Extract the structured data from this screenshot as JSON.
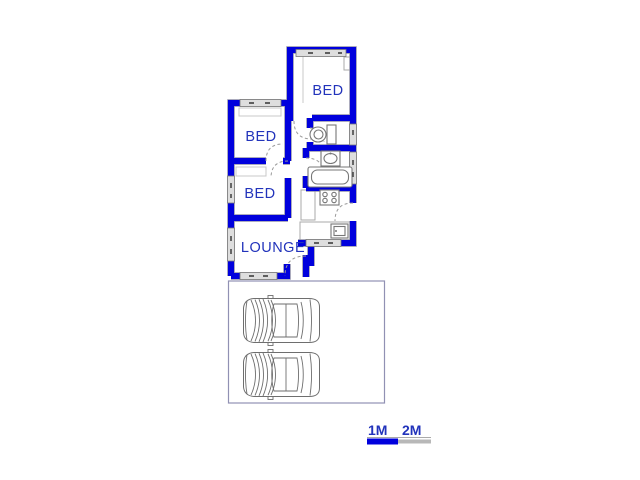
{
  "canvas": {
    "width": 640,
    "height": 480,
    "background": "#ffffff"
  },
  "floorplan": {
    "rooms": [
      {
        "id": "bed-1",
        "label": "BED"
      },
      {
        "id": "bed-2",
        "label": "BED"
      },
      {
        "id": "bed-3",
        "label": "BED"
      },
      {
        "id": "lounge",
        "label": "LOUNGE"
      }
    ],
    "fixture_names": [
      "toilet",
      "basin",
      "bathtub",
      "stove",
      "sink",
      "kitchen-counter",
      "wardrobe"
    ],
    "colors": {
      "wall": "#0000dd",
      "wall_edge": "#8f8fa8",
      "room_label": "#2233bb",
      "fixture_line": "#777777",
      "door_arc": "#999999",
      "window_fill": "#dedede",
      "garage_outline": "#9191b3",
      "car_line": "#6e6e6e"
    }
  },
  "garage": {
    "car_count": 2
  },
  "scale_bar": {
    "labels": [
      "1M",
      "2M"
    ],
    "text_color": "#2233bb",
    "bar_colors": [
      "#0000dd",
      "#b8b8b8"
    ]
  }
}
